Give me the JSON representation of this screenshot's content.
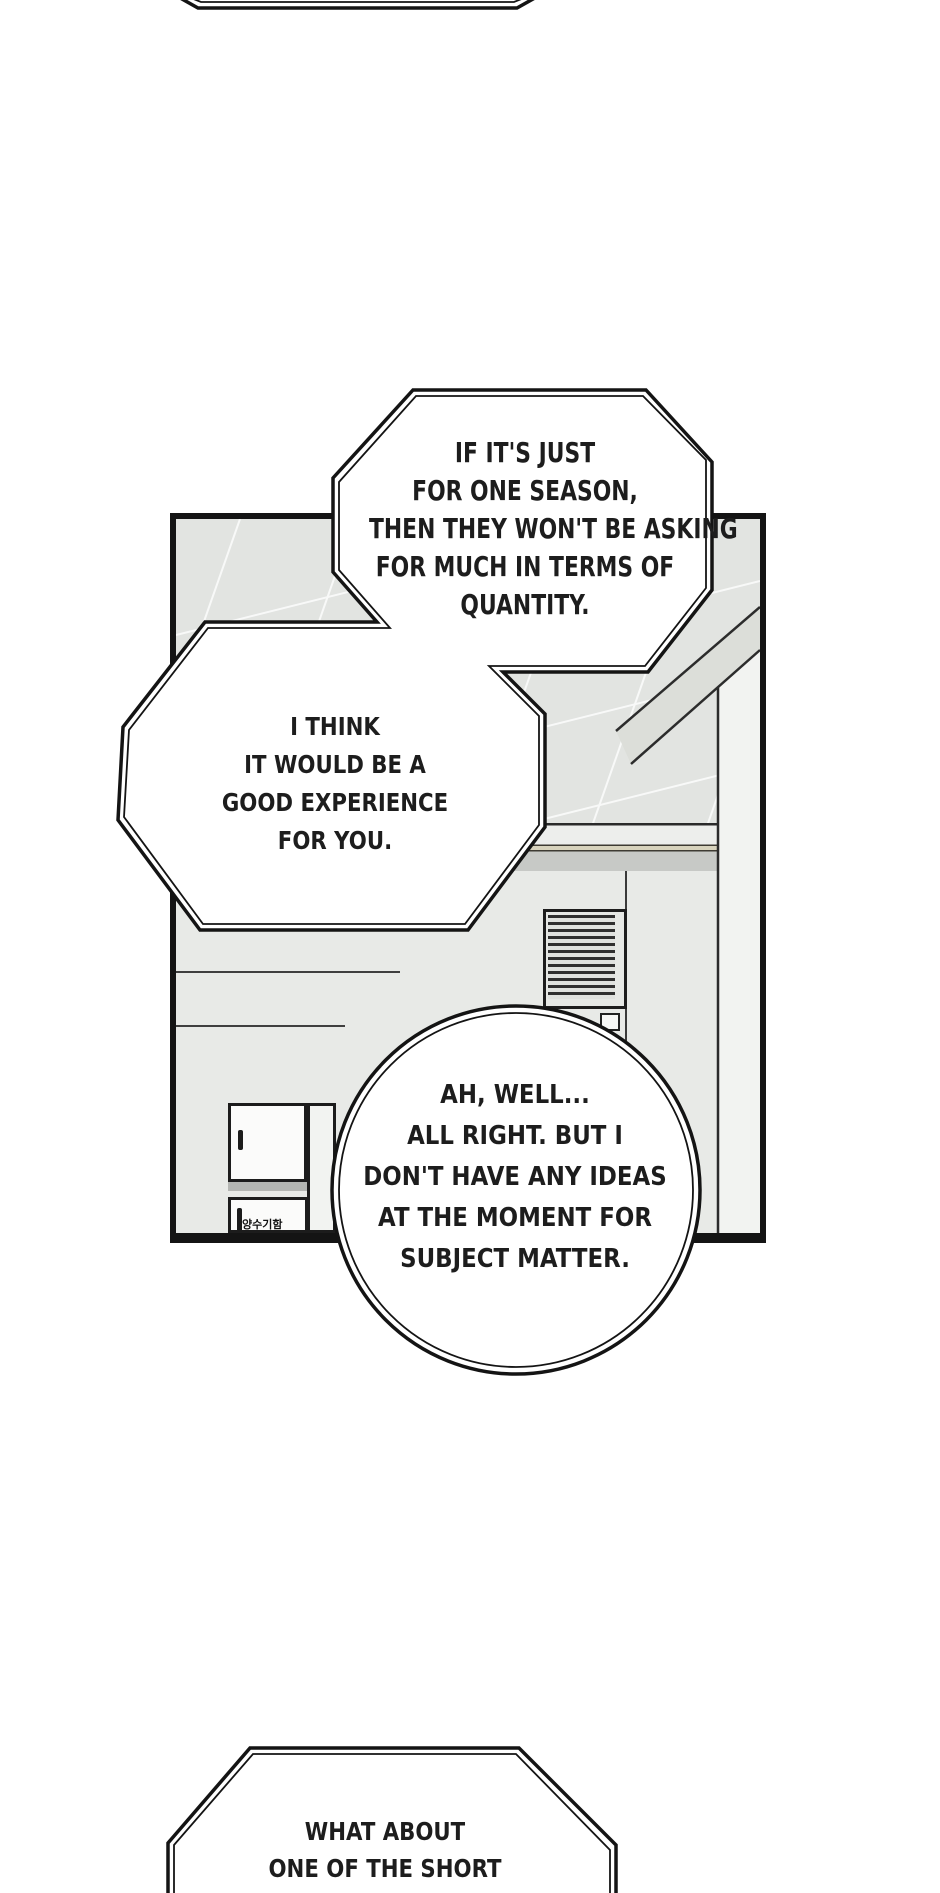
{
  "speech": {
    "bubble1": {
      "shape": "octagon",
      "lines": [
        "IF IT'S JUST",
        "FOR ONE SEASON,",
        "THEN THEY WON'T BE ASKING",
        "FOR MUCH IN TERMS OF",
        "QUANTITY."
      ]
    },
    "bubble2": {
      "shape": "octagon",
      "lines": [
        "I THINK",
        "IT WOULD BE A",
        "GOOD EXPERIENCE",
        "FOR YOU."
      ]
    },
    "bubble3": {
      "shape": "circle",
      "lines": [
        "AH, WELL...",
        "ALL RIGHT. BUT I",
        "DON'T HAVE ANY IDEAS",
        "AT THE MOMENT FOR",
        "SUBJECT MATTER."
      ]
    },
    "bubble4": {
      "shape": "octagon-partial",
      "lines": [
        "WHAT ABOUT",
        "ONE OF THE SHORT"
      ]
    }
  },
  "panel": {
    "sign_text": "양수기함"
  },
  "colors": {
    "ink": "#141414",
    "text": "#1d1d1d",
    "ceiling": "#e2e4e1",
    "wall": "#e8eae7",
    "wall_band": "#edeeec",
    "beige_trim": "#d8d3bd",
    "gray_stripe": "#c7c9c6",
    "door": "#f2f3f1",
    "cabinet": "#fbfbfa",
    "cabinet_shadow": "#b4b6b3",
    "page_bg": "#ffffff"
  }
}
